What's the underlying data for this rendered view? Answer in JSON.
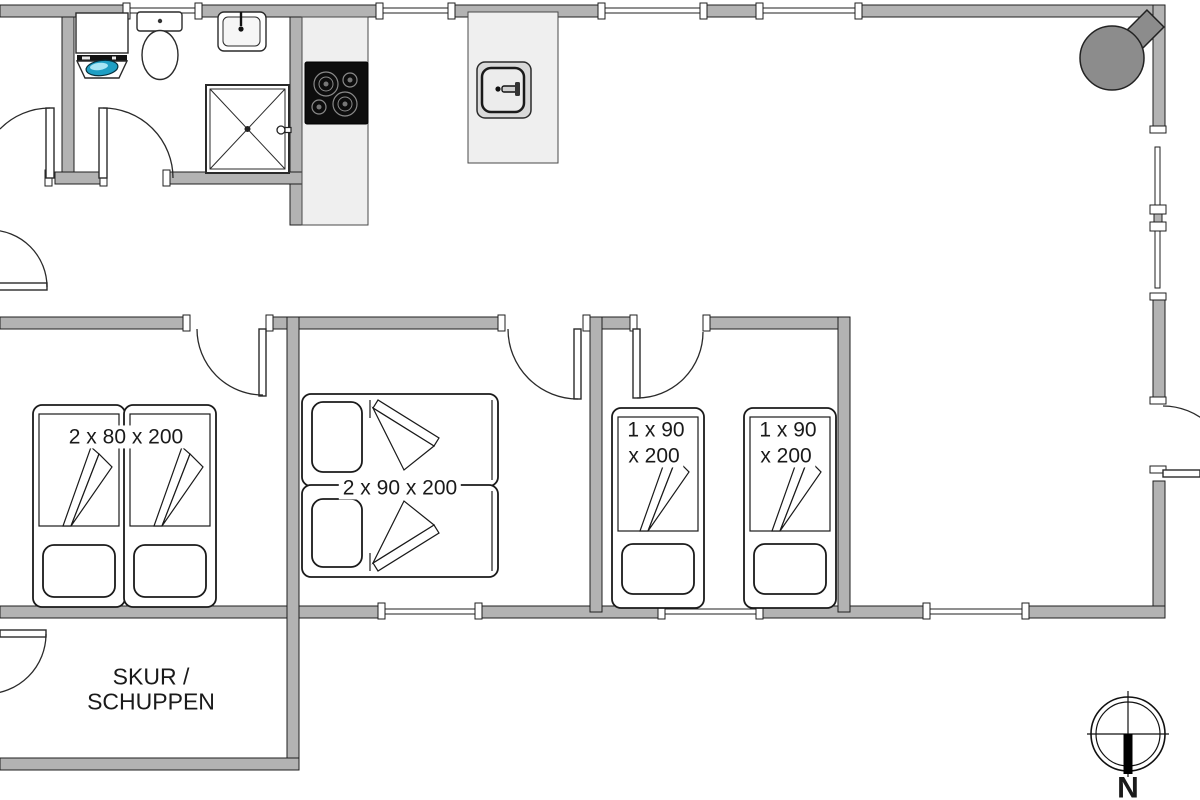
{
  "title": "Holiday house floor plan",
  "labels": {
    "bedroom_left_bed": "2 x 80 x 200",
    "bedroom_middle_bed": "2 x 90 x 200",
    "bed3_line1": "1 x 90",
    "bed3_line2": "x 200",
    "bed4_line1": "1 x 90",
    "bed4_line2": "x 200",
    "shed_line1": "SKUR /",
    "shed_line2": "SCHUPPEN",
    "compass_north": "N"
  },
  "colors": {
    "wall_fill": "#b3b3b3",
    "wall_outline": "#1f1f1f",
    "counter_fill": "#efefef",
    "stove_fill": "#8c8c8c",
    "cooktop_fill": "#0d0d0d",
    "porthole": "#1f9fc4",
    "bg": "#ffffff",
    "ink": "#1a1a1a"
  },
  "fixtures": [
    "washing-machine",
    "toilet",
    "washbasin",
    "shower",
    "cooktop",
    "kitchen-sink",
    "wood-stove",
    "compass-rose",
    "single-bed",
    "double-bed",
    "door-swing",
    "window"
  ]
}
